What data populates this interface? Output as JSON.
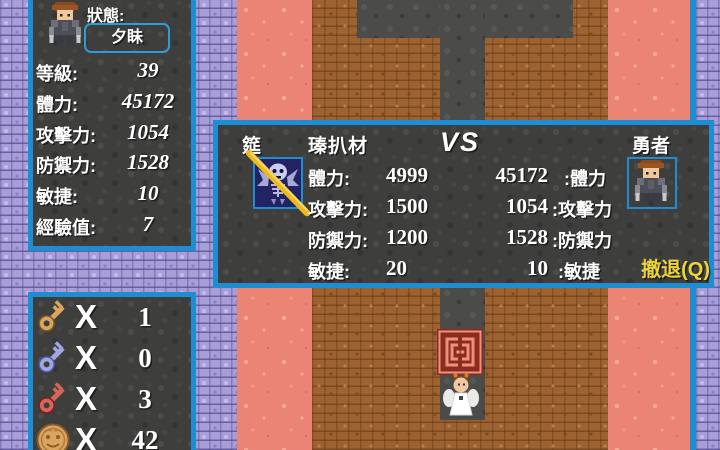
{
  "status_panel": {
    "title": "狀態:",
    "hero_name": "夕眛",
    "rows": [
      {
        "label": "等級:",
        "value": "39"
      },
      {
        "label": "體力:",
        "value": "45172"
      },
      {
        "label": "攻擊力:",
        "value": "1054"
      },
      {
        "label": "防禦力:",
        "value": "1528"
      },
      {
        "label": "敏捷:",
        "value": "10"
      },
      {
        "label": "經驗值:",
        "value": "7"
      }
    ]
  },
  "inventory_panel": {
    "items": [
      {
        "icon": "gold-key-icon",
        "times": "X",
        "count": "1"
      },
      {
        "icon": "blue-key-icon",
        "times": "X",
        "count": "0"
      },
      {
        "icon": "red-key-icon",
        "times": "X",
        "count": "3"
      },
      {
        "icon": "gold-coin-icon",
        "times": "X",
        "count": "42"
      }
    ]
  },
  "battle_dialog": {
    "monster_prefix": "筵",
    "monster_name": "瑧扒材",
    "vs": "VS",
    "hero_title": "勇者",
    "monster_stats": [
      {
        "label": "體力:",
        "value": "4999"
      },
      {
        "label": "攻擊力:",
        "value": "1500"
      },
      {
        "label": "防禦力:",
        "value": "1200"
      },
      {
        "label": "敏捷:",
        "value": "20"
      }
    ],
    "hero_stats": [
      {
        "value": "45172",
        "label": ":體力"
      },
      {
        "value": "1054",
        "label": ":攻擊力"
      },
      {
        "value": "1528",
        "label": ":防禦力"
      },
      {
        "value": "10",
        "label": ":敏捷"
      }
    ],
    "retreat_label": "撤退(Q)"
  },
  "colors": {
    "panel_border": "#1d8ed4",
    "retreat_text": "#ecd33c",
    "slash": "#eeb91e"
  }
}
